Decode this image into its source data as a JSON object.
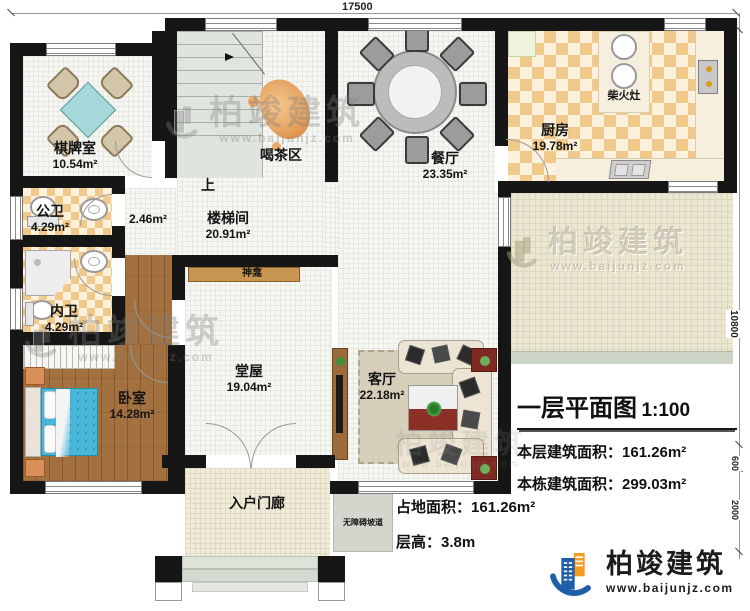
{
  "dimensions": {
    "top": "17500",
    "right_main": "10800",
    "right_small": "600",
    "right_bottom": "2000"
  },
  "rooms": {
    "chess": {
      "name": "棋牌室",
      "area": "10.54m²"
    },
    "tea": {
      "name": "喝茶区"
    },
    "stairwell": {
      "name": "楼梯间",
      "area": "20.91m²"
    },
    "corridor": {
      "area": "2.46m²"
    },
    "up": {
      "label": "上"
    },
    "dining": {
      "name": "餐厅",
      "area": "23.35m²"
    },
    "kitchen": {
      "name": "厨房",
      "area": "19.78m²"
    },
    "wood_stove": {
      "name": "柴火灶"
    },
    "public_bath": {
      "name": "公卫",
      "area": "4.29m²"
    },
    "private_bath": {
      "name": "内卫",
      "area": "4.29m²"
    },
    "bedroom": {
      "name": "卧室",
      "area": "14.28m²"
    },
    "hall": {
      "name": "堂屋",
      "area": "19.04m²"
    },
    "shrine": {
      "name": "神龛"
    },
    "living": {
      "name": "客厅",
      "area": "22.18m²"
    },
    "porch": {
      "name": "入户门廊"
    },
    "ramp": {
      "name": "无障碍坡道"
    }
  },
  "title_block": {
    "title": "一层平面图",
    "scale": "1:100",
    "floor_area_label": "本层建筑面积：",
    "floor_area_value": "161.26m²",
    "building_area_label": "本栋建筑面积：",
    "building_area_value": "299.03m²",
    "site_area_label": "占地面积：",
    "site_area_value": "161.26m²",
    "height_label": "层高：",
    "height_value": "3.8m"
  },
  "branding": {
    "logo_text": "柏竣建筑",
    "logo_url": "www.baijunjz.com"
  },
  "watermark": {
    "text": "柏竣建筑",
    "url": "www.baijunjz.com"
  },
  "colors": {
    "wall": "#161616",
    "accent_blue": "#1f5fa8",
    "accent_orange": "#f39c1f",
    "checker": "#f1c98a",
    "wood": "#a3713f"
  }
}
